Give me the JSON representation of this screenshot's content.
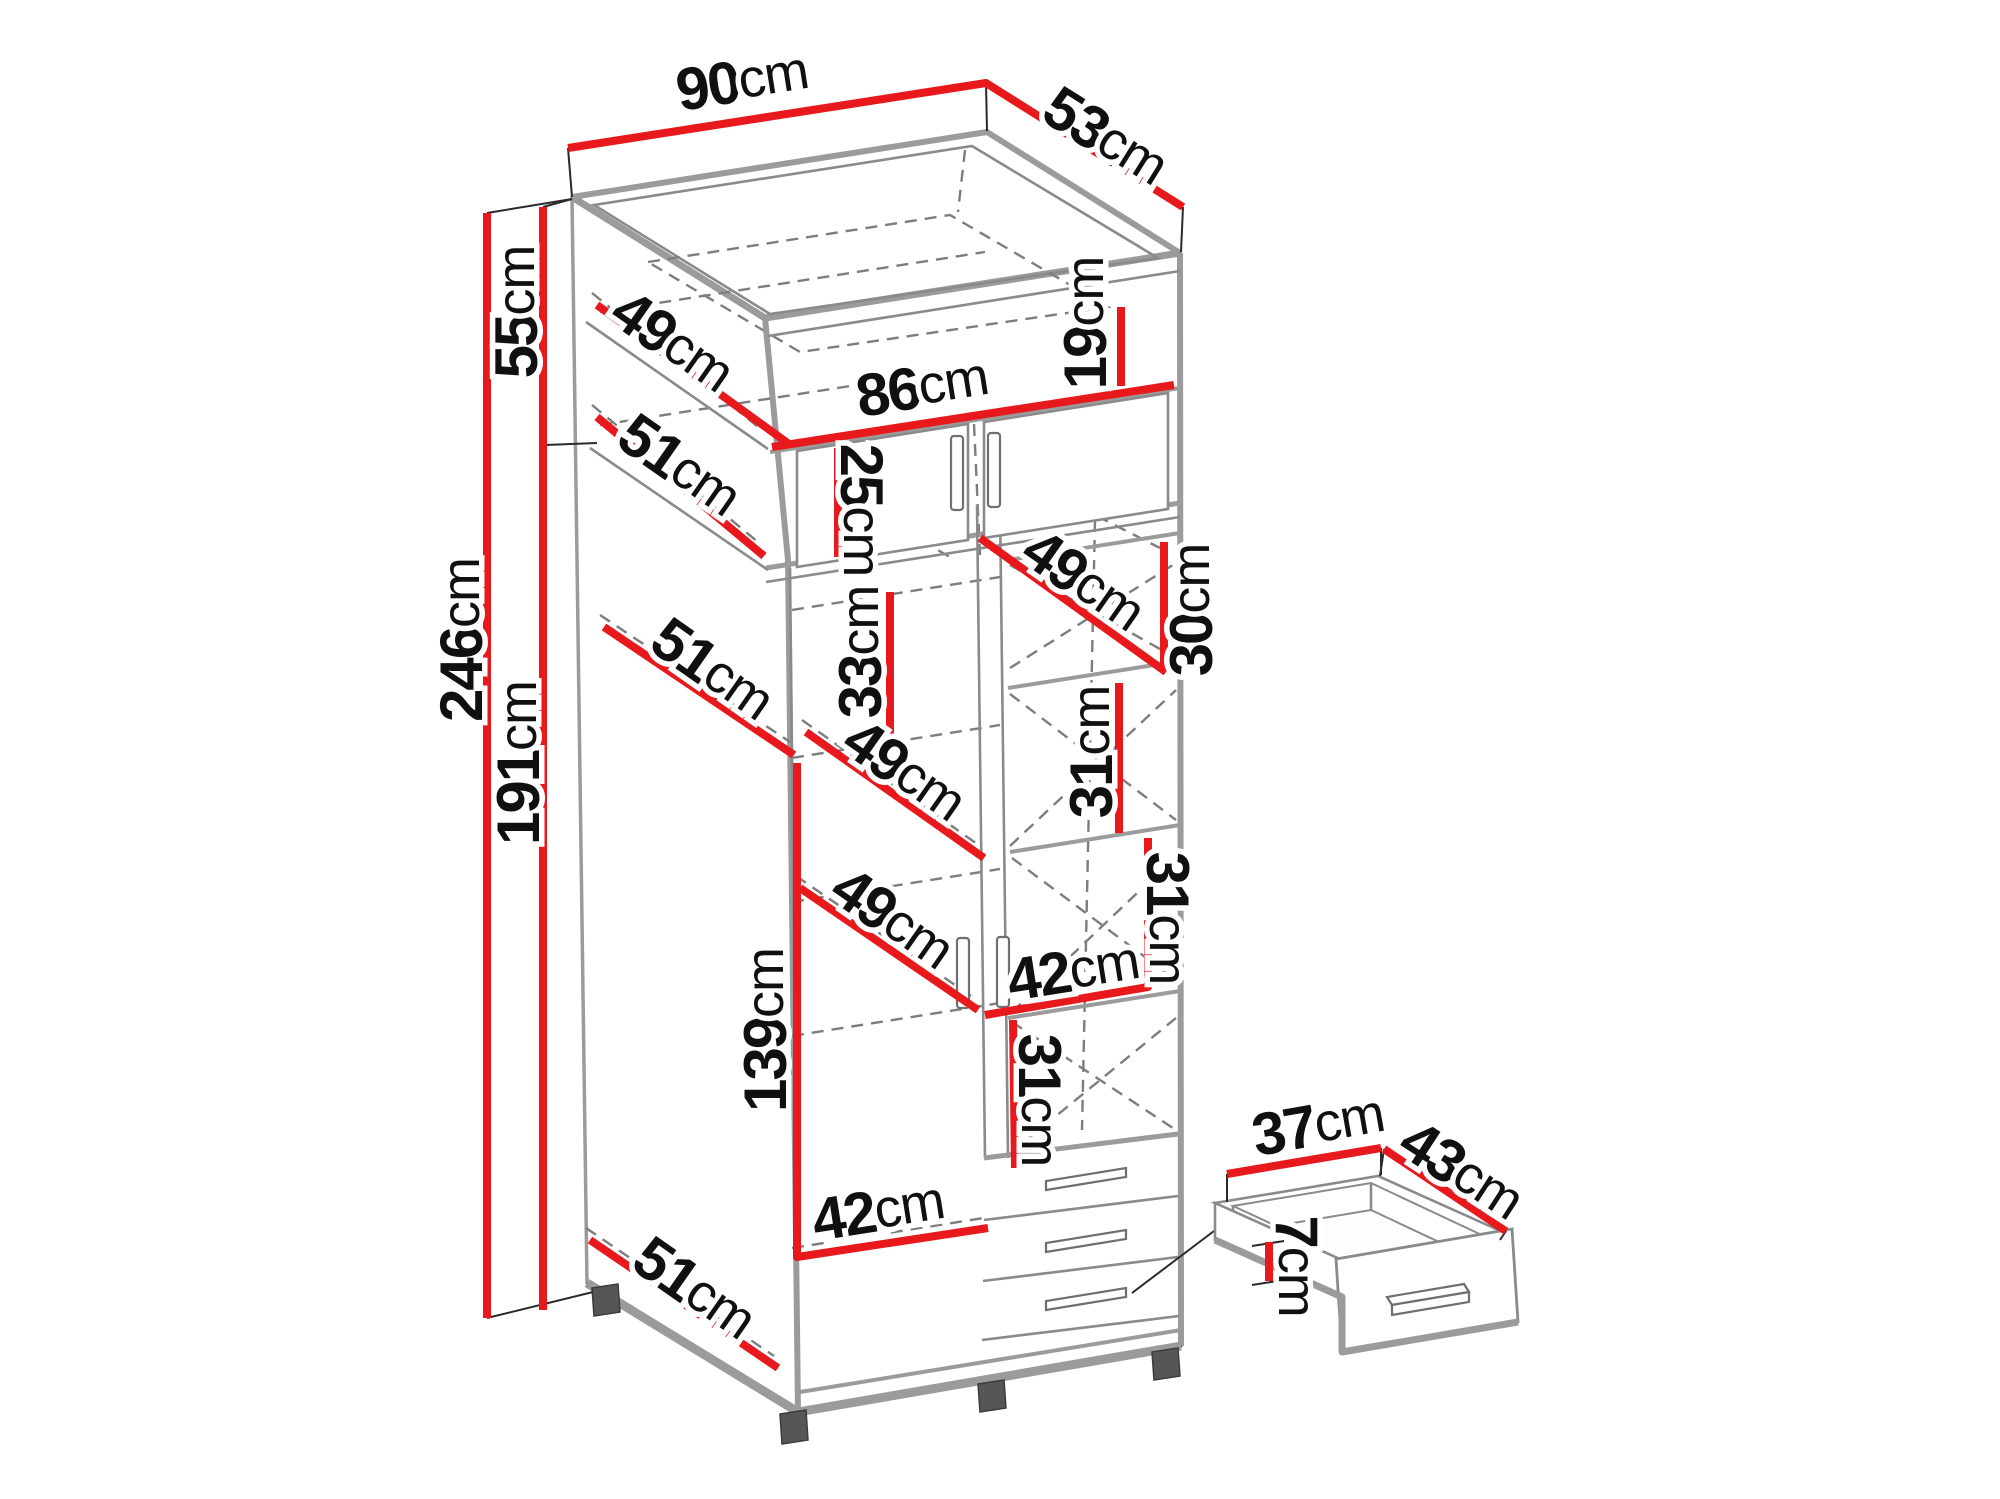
{
  "figure": {
    "kind": "furniture-dimension-diagram",
    "subject": "wardrobe with top cabinet, shelves, three drawers and pull-out drawer",
    "background": "#ffffff",
    "unit": "cm"
  },
  "colors": {
    "dimension_red": "#e8191c",
    "outline_dark": "#2a2a2a",
    "panel_gray": "#9b9b9b",
    "dash_gray": "#7d7d7d",
    "text": "#101010",
    "foot": "#565656"
  },
  "wardrobe": {
    "width_cm": 90,
    "depth_cm": 53,
    "height_cm": 246,
    "top_section_height_cm": 55,
    "lower_section_height_cm": 191,
    "interior_width_cm": 86,
    "hanging_space_height_cm": 139
  },
  "pullout_drawer": {
    "width_cm": 37,
    "depth_cm": 43,
    "height_cm": 7
  },
  "labels": [
    {
      "id": "width-total",
      "num": "90",
      "unit": "cm",
      "x": 742,
      "y": 80,
      "rot": -9
    },
    {
      "id": "depth-total",
      "num": "53",
      "unit": "cm",
      "x": 1106,
      "y": 136,
      "rot": 32
    },
    {
      "id": "top-section-height",
      "num": "55",
      "unit": "cm",
      "x": 516,
      "y": 312,
      "rot": -90
    },
    {
      "id": "height-total",
      "num": "246",
      "unit": "cm",
      "x": 461,
      "y": 640,
      "rot": -90
    },
    {
      "id": "lower-section-height",
      "num": "191",
      "unit": "cm",
      "x": 518,
      "y": 763,
      "rot": -90
    },
    {
      "id": "top-shelf-depth",
      "num": "49",
      "unit": "cm",
      "x": 673,
      "y": 341,
      "rot": 35
    },
    {
      "id": "top-section-depth",
      "num": "51",
      "unit": "cm",
      "x": 680,
      "y": 465,
      "rot": 35
    },
    {
      "id": "interior-width",
      "num": "86",
      "unit": "cm",
      "x": 922,
      "y": 386,
      "rot": -9
    },
    {
      "id": "top-tray-height",
      "num": "19",
      "unit": "cm",
      "x": 1085,
      "y": 323,
      "rot": -90
    },
    {
      "id": "top-door-height",
      "num": "25",
      "unit": "cm",
      "x": 862,
      "y": 510,
      "rot": 90
    },
    {
      "id": "shelf-depth-upper",
      "num": "49",
      "unit": "cm",
      "x": 1084,
      "y": 580,
      "rot": 35
    },
    {
      "id": "gap-30",
      "num": "30",
      "unit": "cm",
      "x": 1191,
      "y": 610,
      "rot": -90
    },
    {
      "id": "interior-depth-51",
      "num": "51",
      "unit": "cm",
      "x": 713,
      "y": 669,
      "rot": 35
    },
    {
      "id": "gap-33",
      "num": "33",
      "unit": "cm",
      "x": 860,
      "y": 652,
      "rot": -90
    },
    {
      "id": "shelf-depth-mid",
      "num": "49",
      "unit": "cm",
      "x": 905,
      "y": 770,
      "rot": 35
    },
    {
      "id": "gap-31a",
      "num": "31",
      "unit": "cm",
      "x": 1091,
      "y": 752,
      "rot": -90
    },
    {
      "id": "shelf-depth-lower",
      "num": "49",
      "unit": "cm",
      "x": 893,
      "y": 918,
      "rot": 35
    },
    {
      "id": "gap-31b",
      "num": "31",
      "unit": "cm",
      "x": 1168,
      "y": 918,
      "rot": 90
    },
    {
      "id": "column-width",
      "num": "42",
      "unit": "cm",
      "x": 1073,
      "y": 970,
      "rot": -9
    },
    {
      "id": "gap-31c",
      "num": "31",
      "unit": "cm",
      "x": 1040,
      "y": 1100,
      "rot": 90
    },
    {
      "id": "hanging-height",
      "num": "139",
      "unit": "cm",
      "x": 765,
      "y": 1030,
      "rot": -90
    },
    {
      "id": "section-width",
      "num": "42",
      "unit": "cm",
      "x": 878,
      "y": 1210,
      "rot": -9
    },
    {
      "id": "bottom-depth",
      "num": "51",
      "unit": "cm",
      "x": 695,
      "y": 1288,
      "rot": 35
    },
    {
      "id": "drawer-width",
      "num": "37",
      "unit": "cm",
      "x": 1318,
      "y": 1124,
      "rot": -10
    },
    {
      "id": "drawer-depth",
      "num": "43",
      "unit": "cm",
      "x": 1462,
      "y": 1170,
      "rot": 33
    },
    {
      "id": "drawer-height",
      "num": "7",
      "unit": "cm",
      "x": 1297,
      "y": 1266,
      "rot": 90
    }
  ]
}
